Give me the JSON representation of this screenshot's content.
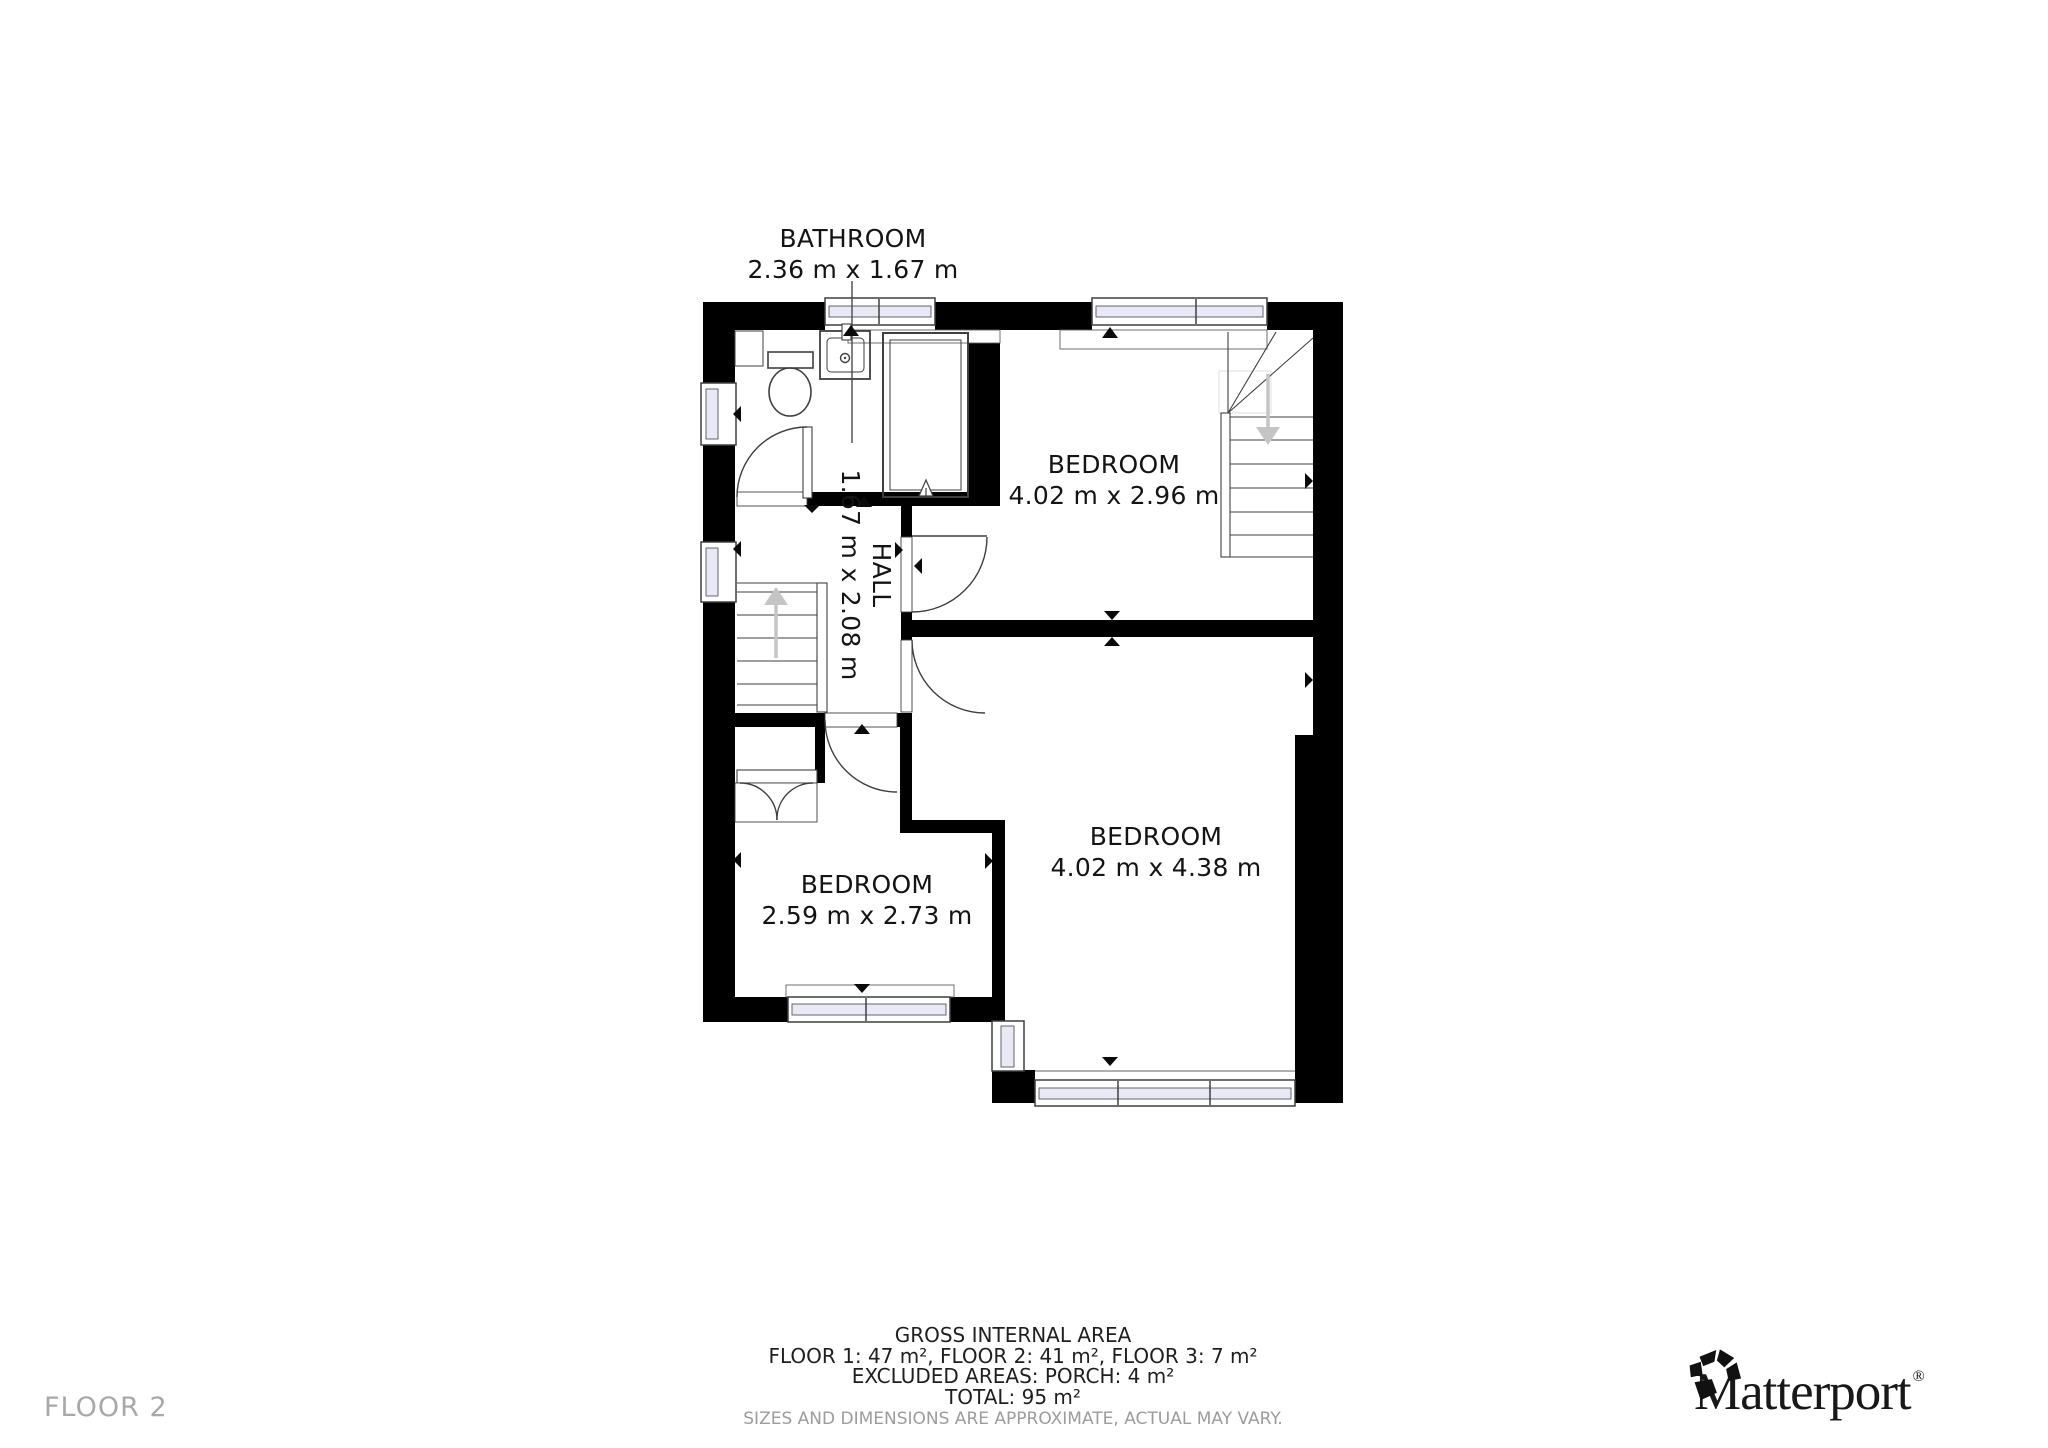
{
  "floor_label": "FLOOR 2",
  "rooms": [
    {
      "id": "bathroom",
      "name": "BATHROOM",
      "dimensions": "2.36 m x 1.67 m"
    },
    {
      "id": "bedroom-top",
      "name": "BEDROOM",
      "dimensions": "4.02 m x 2.96 m"
    },
    {
      "id": "hall",
      "name": "HALL",
      "dimensions": "1.67 m x 2.08 m"
    },
    {
      "id": "bedroom-right",
      "name": "BEDROOM",
      "dimensions": "4.02 m x 4.38 m"
    },
    {
      "id": "bedroom-left",
      "name": "BEDROOM",
      "dimensions": "2.59 m x 2.73 m"
    }
  ],
  "footer": {
    "title": "GROSS INTERNAL AREA",
    "floors": "FLOOR 1: 47 m², FLOOR 2: 41 m², FLOOR 3: 7 m²",
    "excluded": "EXCLUDED AREAS: PORCH: 4 m²",
    "total": "TOTAL: 95 m²",
    "disclaimer": "SIZES AND DIMENSIONS ARE APPROXIMATE, ACTUAL MAY VARY."
  },
  "brand": {
    "name": "Matterport",
    "registered": "®"
  },
  "icons": {
    "brand_icon": "matterport-pinwheel",
    "hall_stairs_arrow": "arrow-up",
    "upper_stairs_arrow": "arrow-down",
    "fixtures": [
      "toilet",
      "sink",
      "shower"
    ]
  },
  "colors": {
    "wall": "#000000",
    "line": "#3f3f3f",
    "glazing": "#e8e9f4",
    "muted_text": "#9c9c9c",
    "stair_arrow": "#c5c5c5"
  }
}
